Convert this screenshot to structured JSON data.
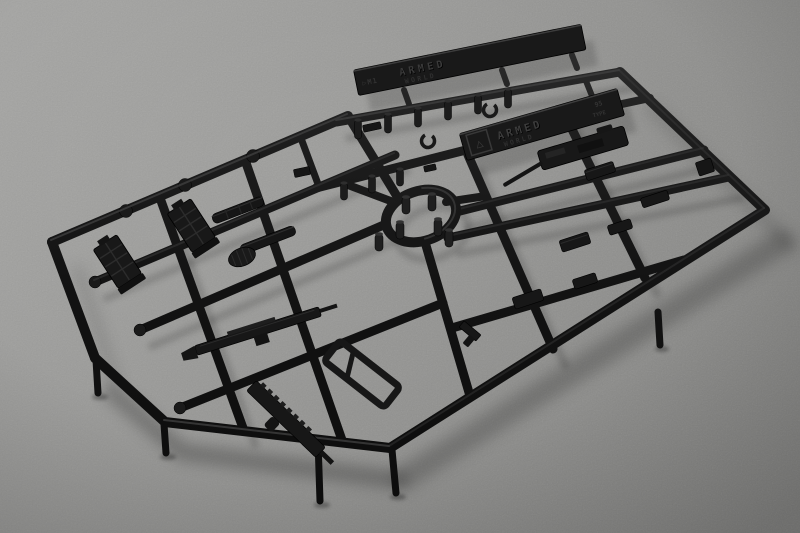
{
  "scene": {
    "type": "product-photo",
    "subject": "black injection-molded plastic model-kit sprue with miniature weapon parts on a gray textured surface",
    "surface_color": "#999997",
    "plastic_color": "#141414",
    "shadow_color": "#000000"
  },
  "nameplates": {
    "tag1": {
      "mold_mark": "▷M1",
      "brand_line1": "ARMED",
      "brand_line2": "WORLD"
    },
    "tag2": {
      "runner_symbol": "△",
      "brand_line1": "ARMED",
      "brand_line2": "WORLD",
      "spec_top": "95",
      "spec_bottom": "TYPE"
    }
  },
  "parts_semantic": [
    "magazine",
    "magazine",
    "suppressor",
    "suppressor",
    "drum-sight",
    "assault-rifle-body",
    "rail-receiver",
    "skeleton-stock",
    "rifle-receiver",
    "scope-block",
    "stock-block",
    "grip-block",
    "pistol",
    "molding-pegs",
    "c-clips",
    "center-ring"
  ]
}
